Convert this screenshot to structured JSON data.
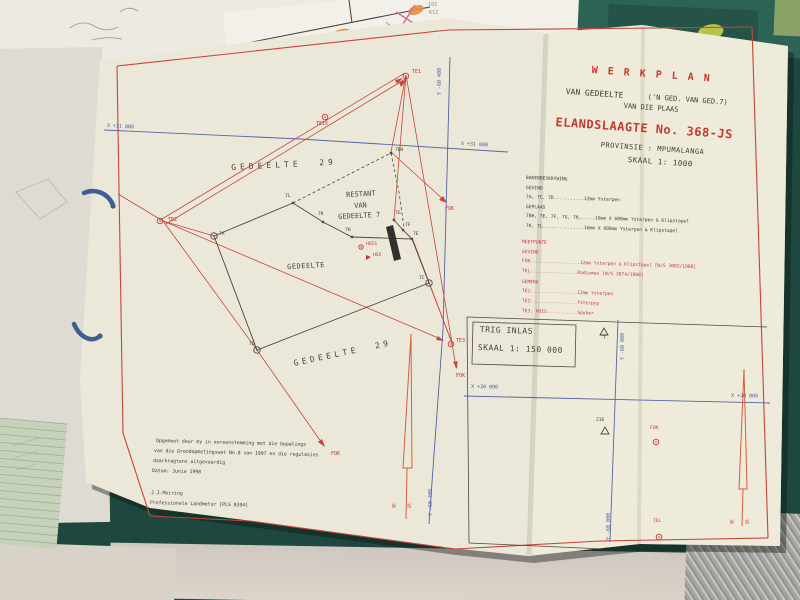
{
  "colors": {
    "plan_red": "#c5463a",
    "plan_blue": "#4a5c9e",
    "legend_red": "#c23a4e",
    "ink_black": "#3f3a32",
    "north_orange": "#d4603f",
    "paper": "#ebe8da",
    "table_teal": "#1d473f"
  },
  "underlay": {
    "mark_line1": "102",
    "mark_line2": "K12"
  },
  "title_block": {
    "title": "W E R K P L A N",
    "subtitle_left": "VAN GEDEELTE",
    "subtitle_right": "('N GED. VAN GED.7)",
    "subtitle2": "VAN DIE PLAAS",
    "farm": "ELANDSLAAGTE No. 368-JS",
    "province": "PROVINSIE : MPUMALANGA",
    "scale": "SKAAL 1: 1000"
  },
  "legend": {
    "beacons_title": "BAKENBESKRYWING",
    "found_label": "GEVIND",
    "found_line": "7A, 7C, 7D...........12mm Ysterpen",
    "placed_label": "GEPLAAS",
    "placed_line1": "7BH, 7E, 7F, 7G, 7H,.....16mm X 600mm Ysterpen & Klipstapel",
    "placed_line2": "7K, 7L...............16mm X 600mm Ysterpen & Klipstapel",
    "meetpunte_title": "MEETPUNTE",
    "meet_found_label": "GEVIND",
    "meet_found_line1": "FOK..................12mm Ysterpen & Klipstapel [W/S 3082/1988]",
    "meet_found_line2": "TEL.................Radiomas [W/S 3074/1988]",
    "marked_label": "GEMERK",
    "marked_line1": "TE1.................12mm Ysterpen",
    "marked_line2": "TE2.................Ysterpyp",
    "marked_line3": "TE3, HUIS...........Spyker"
  },
  "plan": {
    "grid_x_label": "X +31 800",
    "grid_y_label": "Y -60 400",
    "parcel_29": "GEDEELTE  29",
    "parcel_new": "GEDEELTE",
    "restant_line1": "RESTANT",
    "restant_line2": "VAN",
    "restant_line3": "GEDEELTE 7",
    "points": {
      "p7bh": "7BH",
      "p7l": "7L",
      "p7k": "7K",
      "p7h": "7H",
      "p7a": "7A",
      "p7g": "7G",
      "p7f": "7F",
      "p7e": "7E",
      "p7c": "7C",
      "p7d": "7D"
    },
    "stations": {
      "te1": "TE1",
      "te1x": "TE1X",
      "te2": "TE2",
      "te3": "TE3",
      "huis": "HUIS",
      "hsx": "HSX",
      "fok": "FOK"
    },
    "north_label": "W N"
  },
  "note": {
    "line1": "Opgemeet deur my in ooreenstemming met die bepalings",
    "line2": "van die Grondopmetingswet No.8 van 1997 en die regulasies",
    "line3": "daarkragtens uitgevaardig",
    "line4": "Datum: Junie 1998",
    "surveyor": "J.J.Meiring",
    "surveyor_title": "Professionele Landmeter [PLS 0394]"
  },
  "trig_inset": {
    "title": "TRIG INLAS",
    "scale": "SKAAL 1: 150 000",
    "beacon_7": "7",
    "beacon_216": "216",
    "fok": "FOK",
    "tel": "TEL",
    "x_label": "X +30 000",
    "y_label": "Y -60 000",
    "north_label": "W N"
  }
}
